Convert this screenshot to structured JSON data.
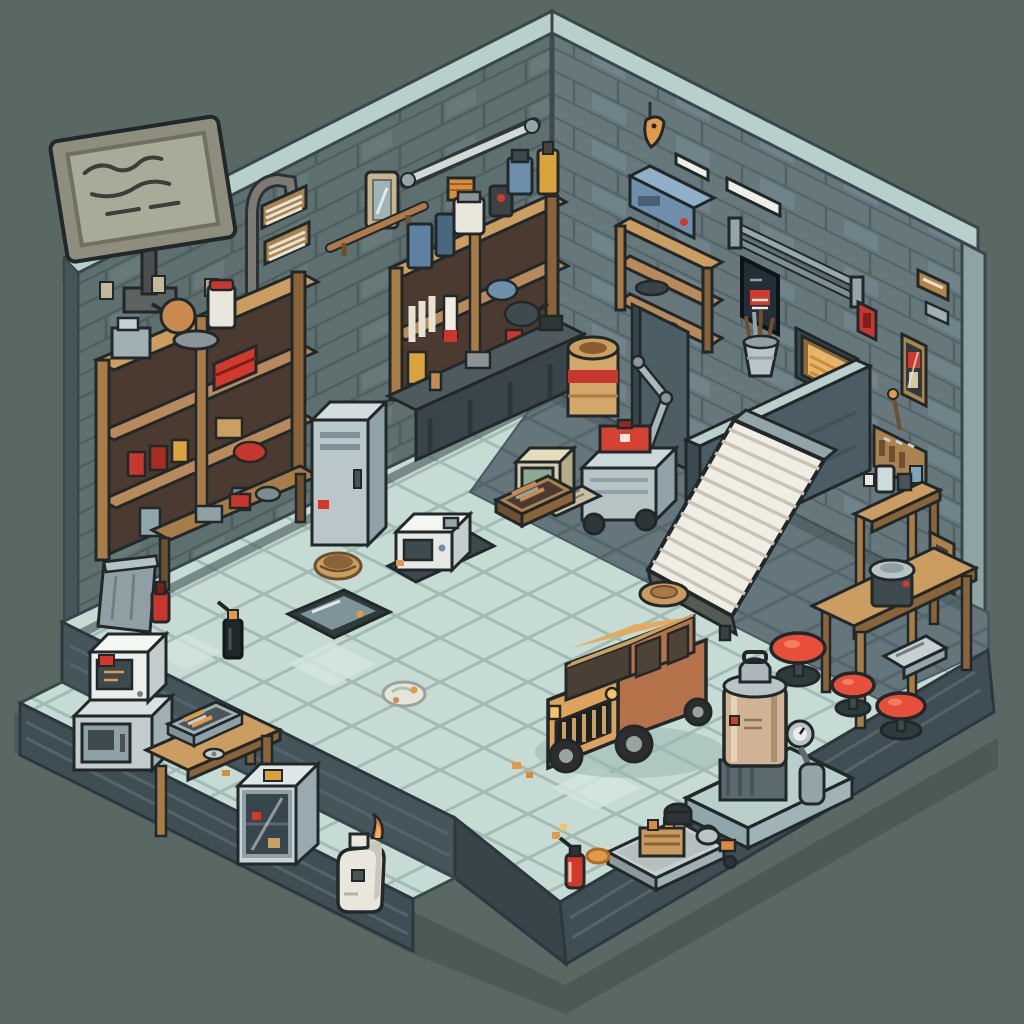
{
  "scene": {
    "setting": "Isometric pixel-art garage workshop interior",
    "projection": "isometric",
    "pixel_art": true,
    "legible_text": "none (sign shows illegible scribbles)"
  },
  "palette": {
    "background": "#5a6864",
    "shadow": "#4c5a57",
    "wall_left": "#5e6f6f",
    "wall_right": "#66787c",
    "wall_brick_line": "#4d5d5d",
    "wall_coping": "#b9cfcb",
    "wall_edge_dark": "#46555a",
    "wall_edge_light": "#8ea4a4",
    "floor_tile": "#c6dbd4",
    "floor_grout": "#a2bbb5",
    "floor_dark": "#64767c",
    "floor_dark_line": "#54656b",
    "platform_side": "#3f4e54",
    "wood_light": "#cb9d60",
    "wood_mid": "#a87c46",
    "wood_dark": "#6e4f2e",
    "metal_light": "#c6d0d1",
    "metal_mid": "#93a5a9",
    "white_paint": "#eceee8",
    "accent_red": "#d0392c",
    "accent_orange": "#e09a4a",
    "stool_red": "#e84f3a",
    "car_body": "#dda25c",
    "car_side": "#b5714a",
    "ramp_white": "#efede4",
    "machine_tan": "#cfb394",
    "machine_blue": "#6d8fab",
    "outline": "#20282a"
  },
  "objects": [
    {
      "id": "tv-sign",
      "label": "wall sign / TV with scribbled screen"
    },
    {
      "id": "chimney-pipe",
      "label": "bent flue pipe over left wall"
    },
    {
      "id": "wall-outlet-plates",
      "label": "small outlet plates on left wall"
    },
    {
      "id": "wall-vent-panels",
      "label": "two wood-framed vent panels"
    },
    {
      "id": "wall-mirror",
      "label": "framed mirror"
    },
    {
      "id": "copper-rail",
      "label": "copper rail with brackets"
    },
    {
      "id": "strip-light-left",
      "label": "tube light fixture, back-left wall"
    },
    {
      "id": "hanging-fish",
      "label": "orange fish hanging at corner"
    },
    {
      "id": "strip-lights-right",
      "label": "white tube lights, right wall"
    },
    {
      "id": "metal-rail-right",
      "label": "long double steel rail"
    },
    {
      "id": "dark-poster",
      "label": "dark poster with red label"
    },
    {
      "id": "red-switch",
      "label": "red switch box"
    },
    {
      "id": "gold-vent",
      "label": "glowing amber framed vent"
    },
    {
      "id": "wall-plaques",
      "label": "small wooden plaques"
    },
    {
      "id": "brass-display-case",
      "label": "tall brass case with red tool"
    },
    {
      "id": "pegboard",
      "label": "pegboard with hand tools"
    },
    {
      "id": "corner-shelf",
      "label": "wooden corner wall shelf with bowls"
    },
    {
      "id": "blue-machine",
      "label": "blue bench machine on corner shelf"
    },
    {
      "id": "left-shelf",
      "label": "big wooden shelf: jars, cans, red toolbox, kettle"
    },
    {
      "id": "under-bench",
      "label": "cluttered low wooden bench"
    },
    {
      "id": "metal-bin",
      "label": "grey metal bin"
    },
    {
      "id": "red-bottle",
      "label": "red bottle"
    },
    {
      "id": "wicker-basket",
      "label": "wicker basket"
    },
    {
      "id": "locker-cabinet",
      "label": "blue-grey locker cabinet"
    },
    {
      "id": "center-shelf",
      "label": "wall shelf with bottles, jugs and cans"
    },
    {
      "id": "workbench",
      "label": "dark workbench against back wall"
    },
    {
      "id": "wall-column",
      "label": "dark wall column"
    },
    {
      "id": "tan-barrel",
      "label": "tan drum with red band"
    },
    {
      "id": "arm-cart",
      "label": "grey cart with lift arm and red toolbox"
    },
    {
      "id": "loading-dock",
      "label": "raised dock platform on right wall"
    },
    {
      "id": "tool-bucket",
      "label": "bucket of tools on dock ledge"
    },
    {
      "id": "ramp",
      "label": "white corrugated ramp"
    },
    {
      "id": "round-pad",
      "label": "round wooden pad"
    },
    {
      "id": "retro-computer",
      "label": "beige retro computer"
    },
    {
      "id": "tool-tray",
      "label": "wooden tray of tools"
    },
    {
      "id": "cnc-machine",
      "label": "small white machine with dark window"
    },
    {
      "id": "oil-pan",
      "label": "oil drain pan"
    },
    {
      "id": "oil-spray-can",
      "label": "black spray can with orange cap"
    },
    {
      "id": "rag",
      "label": "crumpled rag"
    },
    {
      "id": "debris",
      "label": "orange debris crumbs"
    },
    {
      "id": "car",
      "label": "tan SUV with black grille"
    },
    {
      "id": "stool-1",
      "label": "red round stool"
    },
    {
      "id": "stool-2",
      "label": "red round stool"
    },
    {
      "id": "stool-3",
      "label": "red round stool"
    },
    {
      "id": "tall-stand",
      "label": "tall wooden stand with jar and cup"
    },
    {
      "id": "wall-box",
      "label": "wooden wall box"
    },
    {
      "id": "work-table",
      "label": "wooden work table"
    },
    {
      "id": "bench-grinder",
      "label": "bench grinder on table"
    },
    {
      "id": "metal-box",
      "label": "metal box under table"
    },
    {
      "id": "compressor",
      "label": "tan compressor machine with gauge on blue base"
    },
    {
      "id": "engine-tray",
      "label": "metal tray with engine block, pot and kettle"
    },
    {
      "id": "fire-extinguisher",
      "label": "red fire extinguisher"
    },
    {
      "id": "orange-rag",
      "label": "orange rag"
    },
    {
      "id": "microwave-stack",
      "label": "white unit on steel chest, lower ledge"
    },
    {
      "id": "ledge-table",
      "label": "small wooden table with toolbox"
    },
    {
      "id": "display-cabinet",
      "label": "glass display cabinet"
    },
    {
      "id": "fuel-jug",
      "label": "white jug with flame sticker"
    }
  ]
}
